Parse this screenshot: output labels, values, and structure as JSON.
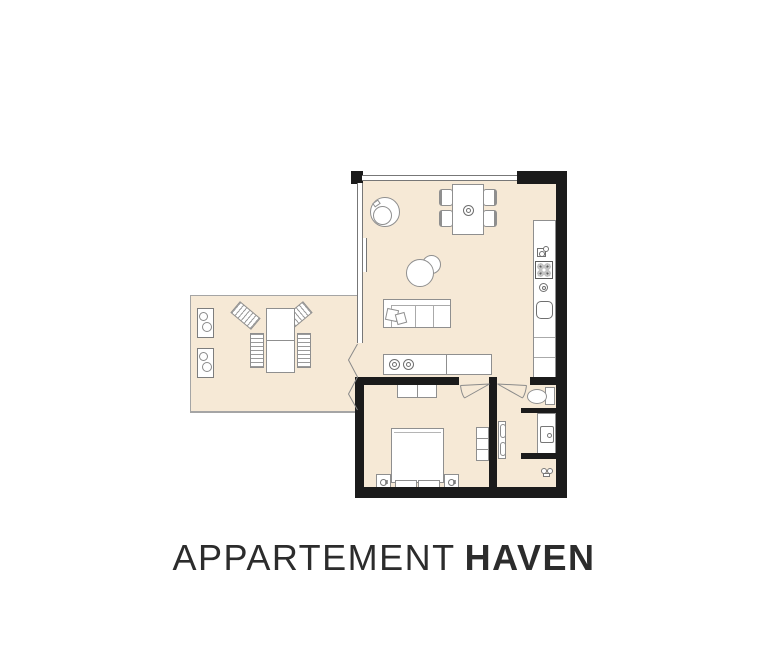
{
  "title": {
    "word_light": "APPARTEMENT",
    "word_bold": "HAVEN"
  },
  "colors": {
    "background": "#ffffff",
    "floor": "#f6e9d6",
    "wall": "#1b1b1b",
    "outline": "#8f8f8f",
    "window_line": "#777777",
    "terrace_line": "#a5a5a5",
    "title_text": "#2c2c2c"
  },
  "legend": {
    "living_kitchen": [
      "round-armchair",
      "dining-table-with-four-chairs",
      "wall-radiator",
      "pouf-side-tables",
      "sofa-with-pillows",
      "sideboard-with-washer-dryer",
      "kitchen-counter",
      "coffee-machine",
      "four-burner-hob",
      "control-knob",
      "kitchen-sink"
    ],
    "bedroom": [
      "wardrobe",
      "double-bed",
      "two-nightstands-with-lamps",
      "dresser"
    ],
    "bathroom": [
      "toilet",
      "vanity-with-sink",
      "towel-radiator",
      "water-tap"
    ],
    "terrace": [
      "two-planters",
      "outdoor-table",
      "four-slatted-chairs",
      "folding-door"
    ]
  }
}
